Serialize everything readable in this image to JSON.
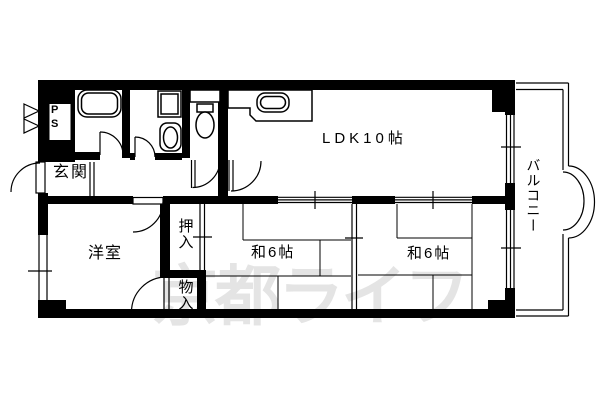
{
  "watermark": "京都ライフ",
  "rooms": {
    "entrance": "玄関",
    "pipe_space": "PS",
    "western_room": "洋室",
    "ldk": "LDK10帖",
    "closet": "押入",
    "storage": "物入",
    "japanese_room_left": "和6帖",
    "japanese_room_right": "和6帖",
    "balcony": "バルコニー"
  },
  "colors": {
    "line": "#000000",
    "background": "#ffffff",
    "watermark": "#e4e4e4"
  }
}
